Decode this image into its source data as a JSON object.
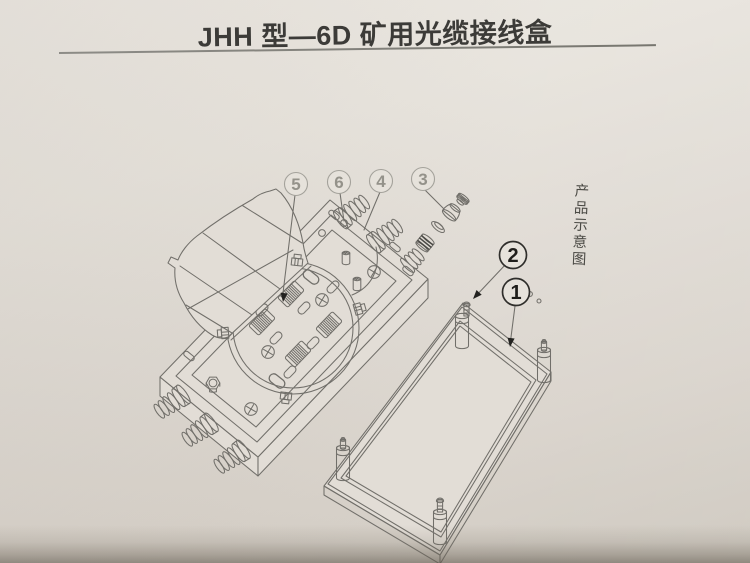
{
  "page": {
    "title": "JHH 型—6D 矿用光缆接线盒",
    "side_label": "产品示意图"
  },
  "drawing": {
    "callouts": [
      {
        "label": "1"
      },
      {
        "label": "2"
      },
      {
        "label": "3"
      },
      {
        "label": "4"
      },
      {
        "label": "5"
      },
      {
        "label": "6"
      }
    ]
  },
  "colors": {
    "paper": "#e2ddd6",
    "line": "#716f6a",
    "callout_dark": "#1f1e1b",
    "callout_light": "#94928a",
    "bottom_shadow": "#a19a8f"
  }
}
